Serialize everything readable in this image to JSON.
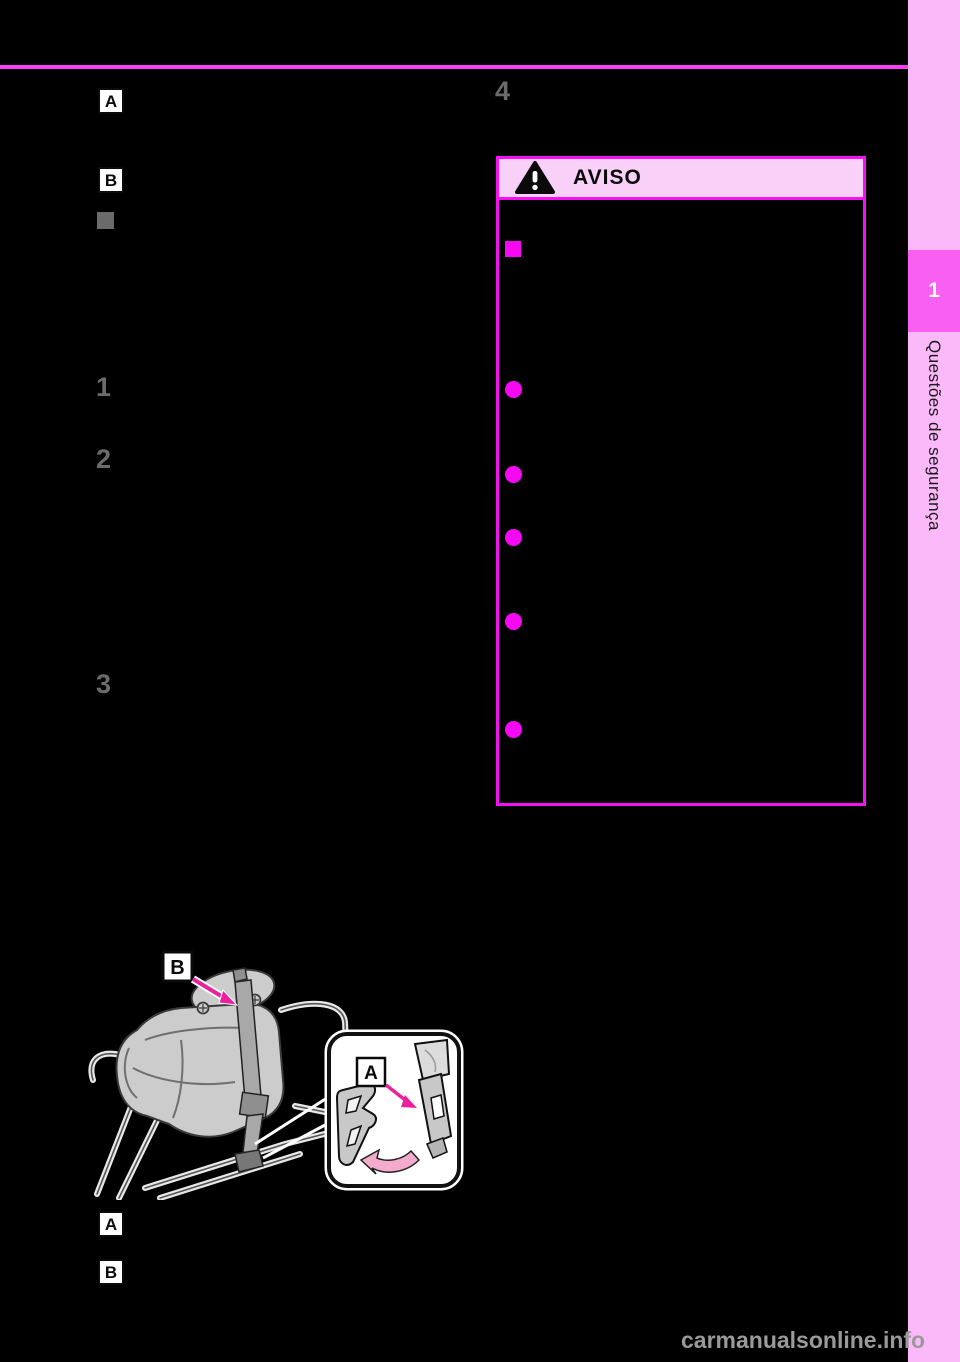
{
  "page": {
    "background_color": "#000000",
    "accent_magenta": "#fb3ef8",
    "watermark": "carmanualsonline.info"
  },
  "sidebar": {
    "bg_color": "#fbb9f9",
    "tab_bg_color": "#f960f1",
    "tab_number": "1",
    "title": "Questões de segurança"
  },
  "left_column": {
    "label_a": "A",
    "label_b": "B",
    "steps": [
      "1",
      "2",
      "3"
    ]
  },
  "right_column": {
    "step": "4"
  },
  "aviso": {
    "title": "AVISO",
    "icon": "warning-triangle-icon",
    "border_color": "#f511f1",
    "header_bg_color": "#f9d0f7",
    "bullet_color": "#f708f2",
    "bullets": [
      {
        "shape": "square",
        "top": 41
      },
      {
        "shape": "circle",
        "top": 181
      },
      {
        "shape": "circle",
        "top": 266
      },
      {
        "shape": "circle",
        "top": 329
      },
      {
        "shape": "circle",
        "top": 413
      },
      {
        "shape": "circle",
        "top": 521
      }
    ]
  },
  "illustration": {
    "label_a": "A",
    "label_b": "B",
    "bottom_label_a": "A",
    "bottom_label_b": "B",
    "arrow_color": "#e8219d",
    "curved_arrow_color": "#f5abce"
  }
}
